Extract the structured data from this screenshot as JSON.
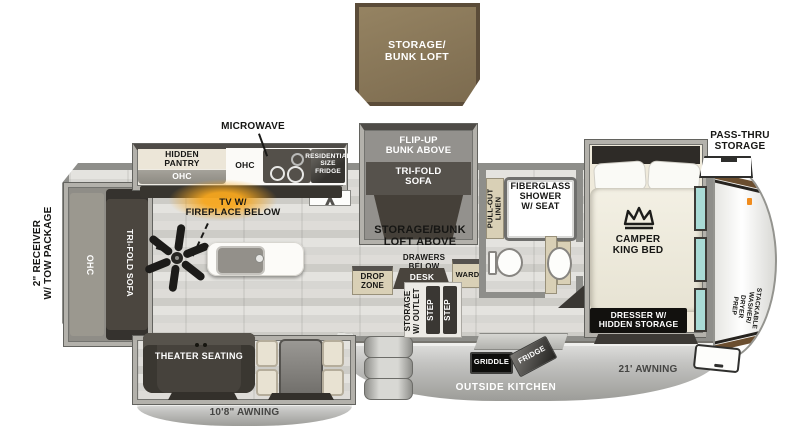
{
  "title": "Fifth-wheel RV floor plan",
  "colors": {
    "loft_brown": "#8a7757",
    "wall_gray": "#8e8e8a",
    "cabinet_tan": "#d9d0b6",
    "window_teal": "#a9dbd6",
    "fireplace_orange": "#f6a21f",
    "dark_furniture": "#46413b",
    "awning_gray": "#c3c3c1"
  },
  "loft": {
    "label": "STORAGE/\nBUNK LOFT"
  },
  "kitchen": {
    "microwave": "MICROWAVE",
    "hidden_pantry": "HIDDEN\nPANTRY",
    "pantry_ohc": "OHC",
    "counter_ohc": "OHC",
    "fridge": "RESIDENTIAL\nSIZE\nFRIDGE"
  },
  "living": {
    "tv": "TV W/\nFIREPLACE BELOW",
    "sofa_ohc": "OHC",
    "sofa": "TRI-FOLD SOFA",
    "theater": "THEATER SEATING"
  },
  "bunk": {
    "flip_up": "FLIP-UP\nBUNK ABOVE",
    "tri_fold": "TRI-FOLD\nSOFA"
  },
  "center": {
    "loft_above": "STORAGE/BUNK\nLOFT ABOVE",
    "drawers": "DRAWERS\nBELOW",
    "desk": "DESK",
    "ward": "WARD",
    "drop_zone": "DROP\nZONE",
    "storage_outlet": "STORAGE\nW/ OUTLET",
    "step_1": "STEP",
    "step_2": "STEP"
  },
  "bath": {
    "linen": "PULL-OUT\nLINEN",
    "shower": "FIBERGLASS\nSHOWER\nW/ SEAT",
    "med": "MED"
  },
  "bedroom": {
    "bed": "CAMPER\nKING BED",
    "dresser": "DRESSER W/\nHIDDEN STORAGE",
    "wardrobe": "WARDROBE",
    "washer": "STACKABLE\nWASHER/\nDRYER\nPREP",
    "pass_thru": "PASS-THRU\nSTORAGE"
  },
  "exterior": {
    "receiver": "2\" RECEIVER\nW/ TOW PACKAGE",
    "awning_small": "10'8\" AWNING",
    "awning_big": "21' AWNING",
    "outside_kitchen": "OUTSIDE KITCHEN",
    "griddle": "GRIDDLE",
    "out_fridge": "FRIDGE"
  }
}
